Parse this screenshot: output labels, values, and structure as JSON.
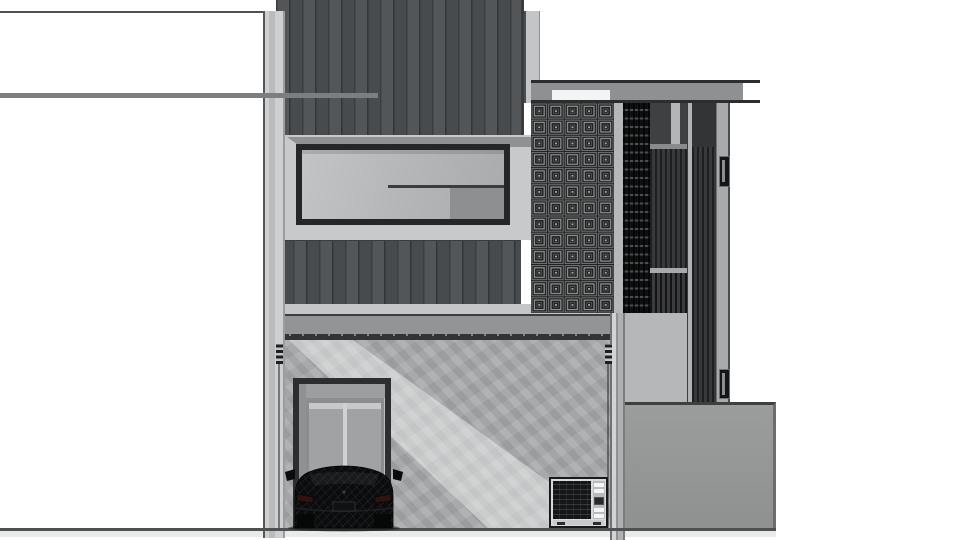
{
  "scene": {
    "type": "architectural-elevation",
    "title": "Modern two-storey house — front elevation render",
    "description": "Monochrome SketchUp-style front elevation: dark vertical standing-seam siding on the upper floor with a full-width ribbon window, a breeze-block ventilation screen and vertical slat privacy screens on the right tower under a thin flat roof canopy, and a concrete carport below with a recessed glazed entry door, a black SUV parked facing away, an outdoor air-conditioning unit, and a grey boundary fence wall on the right.",
    "background": "#ffffff",
    "visible_text": "none"
  },
  "palette": {
    "sky_white": "#ffffff",
    "siding_dark": "#4b4f51",
    "wall_light": "#c7c9ca",
    "concrete_wall": "#a9abac",
    "frame_dark": "#242628",
    "glass": "#b3b5b6",
    "glass_panel_dark": "#8d8f91",
    "slab_face": "#929495",
    "slab_line": "#323435",
    "screen_black": "#0f1011",
    "slat_dark": "#2c2e30",
    "mullion_light": "#b1b3b4",
    "pillar_gray": "#a8aaab",
    "fence_gray": "#9b9d9c",
    "roof_line": "#2b2d2e",
    "roof_fascia": "#8e9091",
    "ground_line": "#4e5051",
    "car_black": "#0b0c0d",
    "ac_body": "#d9dadb",
    "ac_grille": "#151617",
    "breeze_block_bg": "#1f2122"
  },
  "elements": {
    "site_lines": {
      "top_line": "neighbouring roof line (upper left)",
      "mid_line": "adjacent eave line crossing the siding",
      "ground_line": "ground line across full width"
    },
    "upper_floor": {
      "siding_panel": "dark vertical standing-seam siding",
      "ribbon_window": "dark-framed ribbon window with sliding rail and darker lower-right pane",
      "spandrel_band": "dark siding balcony band",
      "floor_slab": "grey floor slab band with drip-edge ticks"
    },
    "right_tower": {
      "breeze_block_screen": {
        "label": "decorative concrete breeze-block screen",
        "columns": 5,
        "rows": 13
      },
      "louver_screen": "black horizontal louver screen",
      "slat_screens": "dark vertical slat screens with light mullions",
      "concrete_pillar": "grey pillar with two recessed dark slots",
      "roof_canopy": "thin flat roof canopy with grey fascia and light gutter patch"
    },
    "ground_floor": {
      "carport_wall": "textured concrete carport wall with diagonal sunlight band",
      "entry_door": "recessed dark-framed entry with double glazed door",
      "car": "black low-poly SUV, rear view, with side mirrors, tail lights and licence plate",
      "ac_unit": "outdoor air-conditioning condenser with dark coil grille and white vent slats",
      "hardware": "roller-guide brackets and thin drain rods at both ends of the opening"
    },
    "fence": "grey boundary fence wall on the right"
  }
}
